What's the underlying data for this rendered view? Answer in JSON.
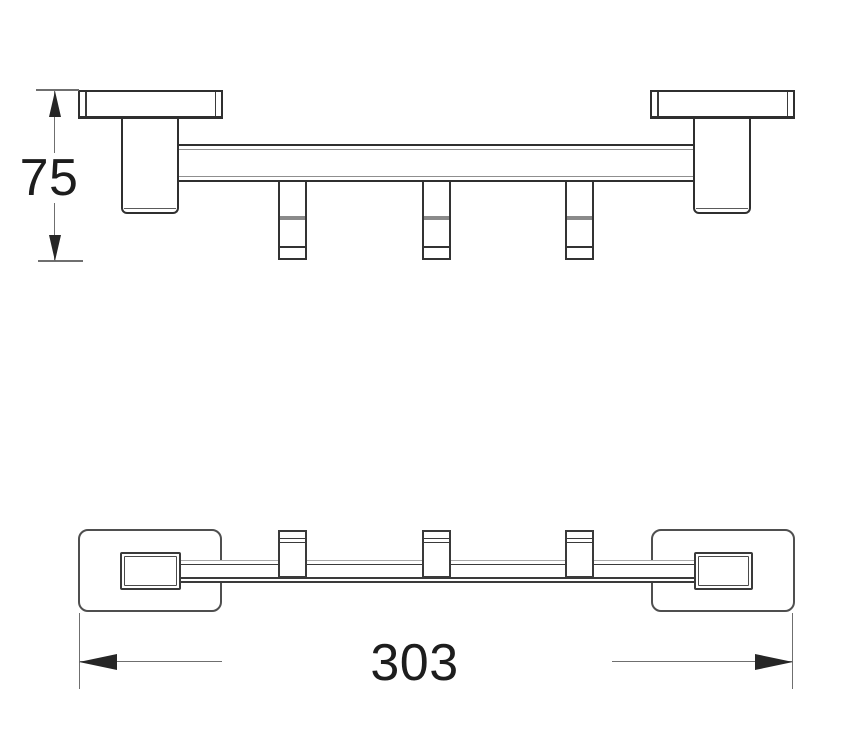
{
  "drawing": {
    "kind": "technical-line-drawing",
    "hook_count": 3,
    "dims": {
      "height": {
        "label": "75",
        "orientation": "vertical"
      },
      "length": {
        "label": "303",
        "orientation": "horizontal"
      }
    },
    "colors": {
      "background": "#ffffff",
      "outline_dark": "#2f2f2f",
      "outline_medium": "#4f4f4f",
      "outline_light": "#8f8f8f",
      "dimension_line": "#6f6f6f",
      "arrowhead": "#262626",
      "text": "#1d1d1d"
    }
  }
}
